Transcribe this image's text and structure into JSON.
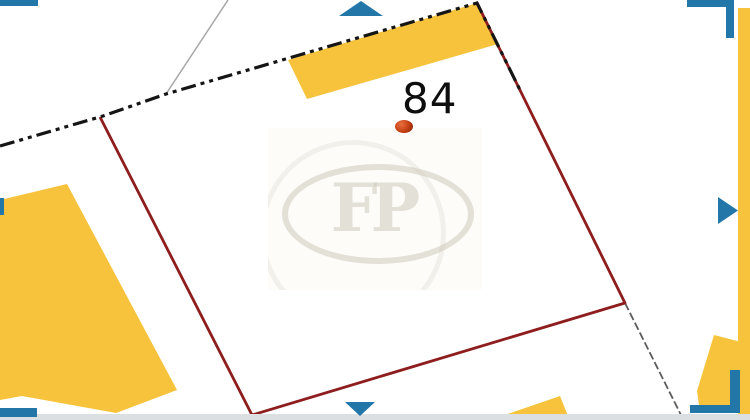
{
  "map": {
    "parcel_label": "84",
    "watermark_initials": "FP"
  },
  "icons": {
    "pan_up": "triangle-up",
    "pan_right": "triangle-right",
    "pan_down": "triangle-down",
    "pan_left": "triangle-left"
  },
  "colors": {
    "building-yellow": "#F7C33C",
    "parcel-red": "#8E1D1D",
    "boundary-black": "#151515",
    "nav-blue": "#2277A8",
    "branch-gray": "#A6A6A6",
    "path-gray": "#5C5C5C",
    "footer-gray": "#DCDFE1",
    "marker-red-dark": "#7A1F02",
    "marker-red-mid": "#C23C12",
    "marker-red-light": "#E8703F",
    "watermark-ink": "rgba(202,195,181,0.5)"
  }
}
